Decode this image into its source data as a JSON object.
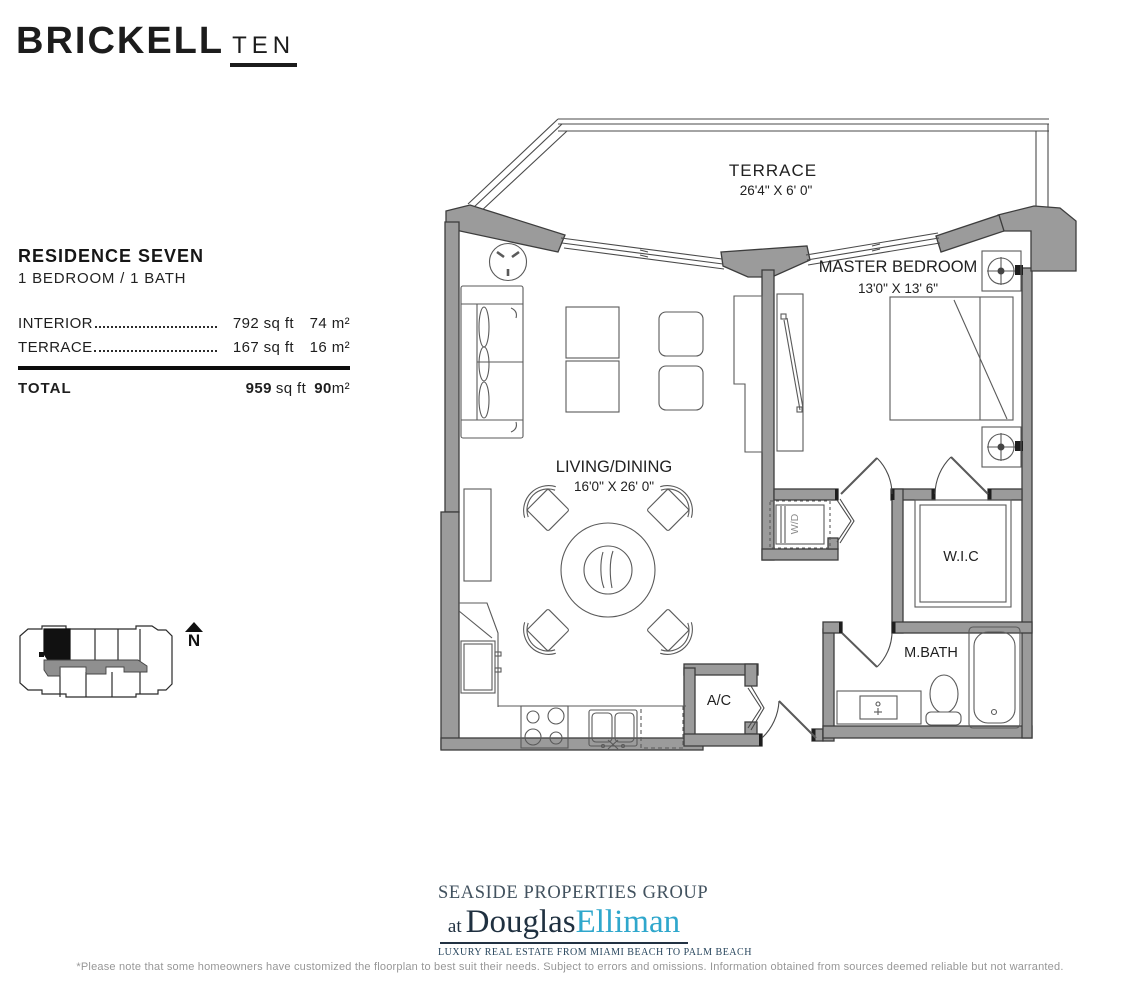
{
  "brand": {
    "main": "BRICKELL",
    "suffix": "TEN"
  },
  "residence": {
    "title": "RESIDENCE SEVEN",
    "subtitle": "1 BEDROOM / 1 BATH",
    "areas": [
      {
        "label": "INTERIOR",
        "sqft": "792 sq ft",
        "sqm": "74 m²"
      },
      {
        "label": "TERRACE",
        "sqft": "167 sq ft",
        "sqm": "16 m²"
      }
    ],
    "total": {
      "label": "TOTAL",
      "sqft_value": "959",
      "sqft_unit": "sq ft",
      "sqm_value": "90",
      "sqm_unit": "m²"
    }
  },
  "floorplan": {
    "terrace": {
      "name": "TERRACE",
      "dims": "26'4\" X 6' 0\""
    },
    "master": {
      "name": "MASTER BEDROOM",
      "dims": "13'0\" X 13' 6\""
    },
    "living": {
      "name": "LIVING/DINING",
      "dims": "16'0\" X 26' 0\""
    },
    "wic": "W.I.C",
    "mbath": "M.BATH",
    "ac": "A/C",
    "wd": "W/D"
  },
  "keyplan": {
    "north_label": "N"
  },
  "brokerage": {
    "group": "SEASIDE PROPERTIES GROUP",
    "at": "at",
    "name_first": "Douglas",
    "name_last": "Elliman",
    "tagline": "LUXURY REAL ESTATE FROM MIAMI BEACH TO PALM BEACH"
  },
  "footer_note": "*Please note that some homeowners have customized the floorplan to best suit their needs. Subject to errors and omissions. Information obtained from sources deemed reliable but not warranted.",
  "colors": {
    "wall_gray": "#9b9b9b",
    "line_dark": "#3d3d3d",
    "brand_text": "#1c1c1c",
    "elliman_blue": "#2fa7cc",
    "elliman_navy": "#1f3040",
    "footer_gray": "#979797"
  }
}
